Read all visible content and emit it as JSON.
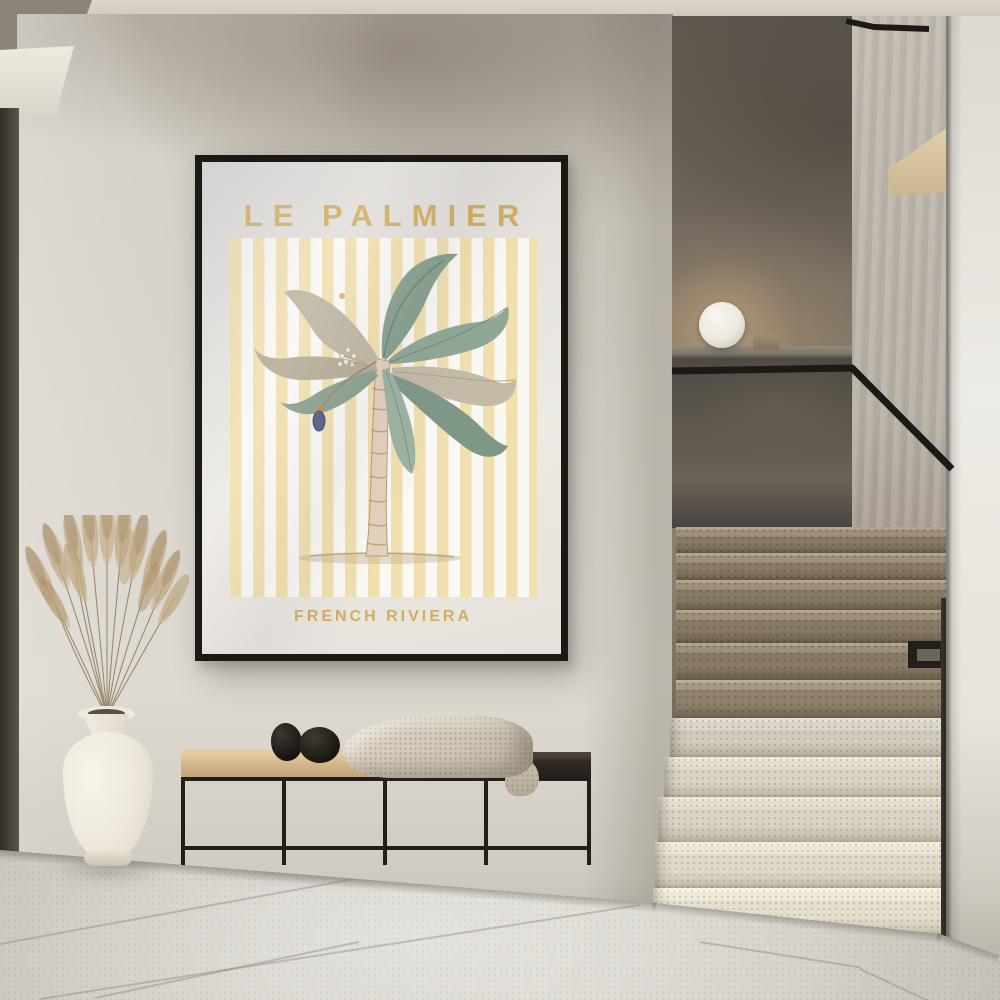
{
  "poster": {
    "title": "LE PALMIER",
    "subtitle": "FRENCH RIVIERA"
  },
  "palette": {
    "poster_gold": "#d2ad62",
    "stripe_yellow": "#f1dfae",
    "poster_paper": "#e7e4df",
    "frame_black": "#1b1916",
    "wall_plaster": "#d5d0c8",
    "stairwell_wall": "#79705f",
    "step_dark": "#8d7f6c",
    "step_light": "#e0dacb",
    "floor_tile": "#d6d3cb",
    "handrail_black": "#1c1a16",
    "bench_cushion_tan": "#d5b98c",
    "bench_wood_dark": "#332d26",
    "vase_cream": "#efe9dc",
    "pampas_tan": "#b49a76",
    "lamp_white": "#f2efe8"
  }
}
